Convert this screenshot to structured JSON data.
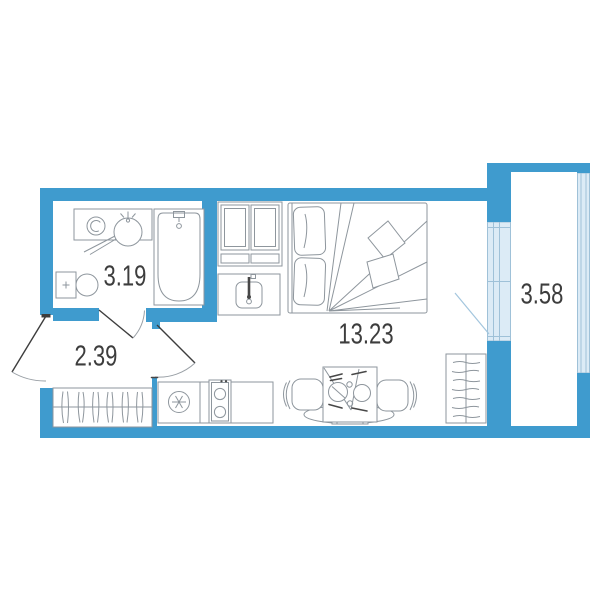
{
  "rooms": {
    "bathroom": {
      "area": "3.19"
    },
    "hallway": {
      "area": "2.39"
    },
    "living_room": {
      "area": "13.23"
    },
    "balcony": {
      "area": "3.58"
    }
  },
  "colors": {
    "background": "#ffffff",
    "wall": "#3f9bce",
    "glazing_fill": "#dcebf6",
    "glazing_frame": "#9fc1d8",
    "furniture_outline": "#8e969d",
    "detail_dark": "#474747",
    "door_leaf": "#3d3d3d",
    "door_arc": "#9aa0a6",
    "balcony_door_line": "#a3c6de",
    "label_text": "#3d3d3d"
  }
}
